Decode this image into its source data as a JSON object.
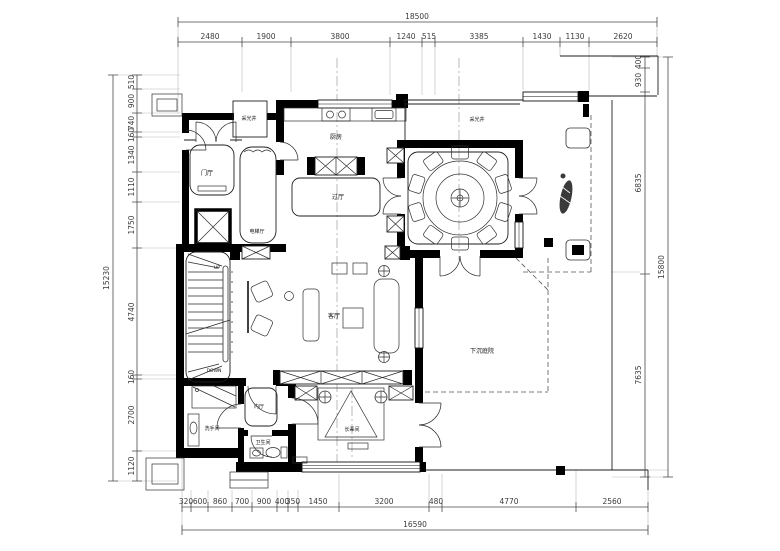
{
  "dimensions": {
    "top": {
      "total": "18500",
      "segments": [
        "2480",
        "1900",
        "3800",
        "1240",
        "515",
        "3385",
        "1430",
        "1130",
        "2620"
      ]
    },
    "left": {
      "total": "15230",
      "segments": [
        "510",
        "900",
        "740",
        "160",
        "1340",
        "1110",
        "1750",
        "4740",
        "160",
        "2700",
        "1120"
      ]
    },
    "right": {
      "total": "15800",
      "segments": [
        "400",
        "930",
        "6835",
        "7635"
      ]
    },
    "bottom": {
      "total": "16590",
      "segments": [
        "320",
        "600",
        "860",
        "700",
        "900",
        "400",
        "350",
        "1450",
        "3200",
        "480",
        "4770",
        "2560"
      ]
    }
  },
  "rooms": {
    "skylight_left": "采光井",
    "skylight_right": "采光井",
    "entry_hall": "门厅",
    "elevator_hall": "电梯厅",
    "kitchen": "厨房",
    "passage_hall": "过厅",
    "living_room": "客厅",
    "inner_hall": "内厅",
    "washroom": "洗手间",
    "bathroom": "卫生间",
    "elders_room": "长辈间",
    "sunken_courtyard": "下沉庭院"
  },
  "stairs": {
    "up": "UP",
    "down": "DOWN"
  },
  "colors": {
    "wall": "#000000",
    "line": "#222222",
    "dim_text": "#3c3c3c",
    "background": "#ffffff"
  }
}
